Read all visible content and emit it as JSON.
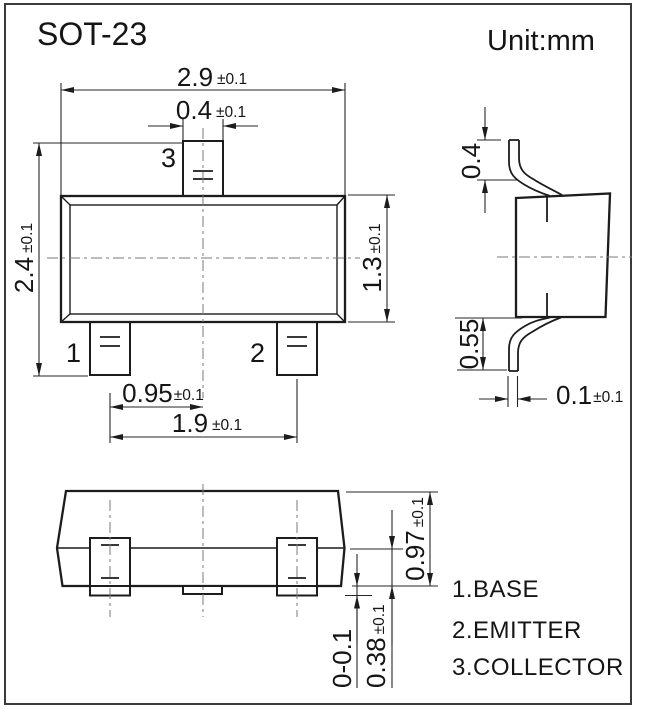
{
  "page": {
    "title": "SOT-23",
    "unit_label": "Unit:mm"
  },
  "front_view": {
    "pin_labels": {
      "pin1": "1",
      "pin2": "2",
      "pin3": "3"
    },
    "dim_body_width": {
      "value": "2.9",
      "tol": "±0.1"
    },
    "dim_pin3_width": {
      "value": "0.4",
      "tol": "±0.1"
    },
    "dim_total_height": {
      "value": "2.4",
      "tol": "±0.1"
    },
    "dim_body_height": {
      "value": "1.3",
      "tol": "±0.1"
    },
    "dim_pin_pitch": {
      "value": "0.95",
      "tol": "±0.1"
    },
    "dim_pin_span": {
      "value": "1.9",
      "tol": "±0.1"
    }
  },
  "side_view": {
    "dim_shoulder_height": {
      "value": "0.4"
    },
    "dim_lead_height": {
      "value": "0.55"
    },
    "dim_lead_thickness": {
      "value": "0.1",
      "tol": "±0.1"
    }
  },
  "bottom_view": {
    "dim_overall_height": {
      "value": "0.97",
      "tol": "±0.1"
    },
    "dim_foot_length": {
      "value": "0.38",
      "tol": "±0.1"
    },
    "dim_standoff": {
      "value": "0-0.1"
    }
  },
  "legend": {
    "items": [
      "1.BASE",
      "2.EMITTER",
      "3.COLLECTOR"
    ]
  },
  "colors": {
    "line": "#1c1c1c",
    "centerline": "#7a7a7a",
    "background": "#ffffff",
    "border": "#3a3a3a"
  }
}
